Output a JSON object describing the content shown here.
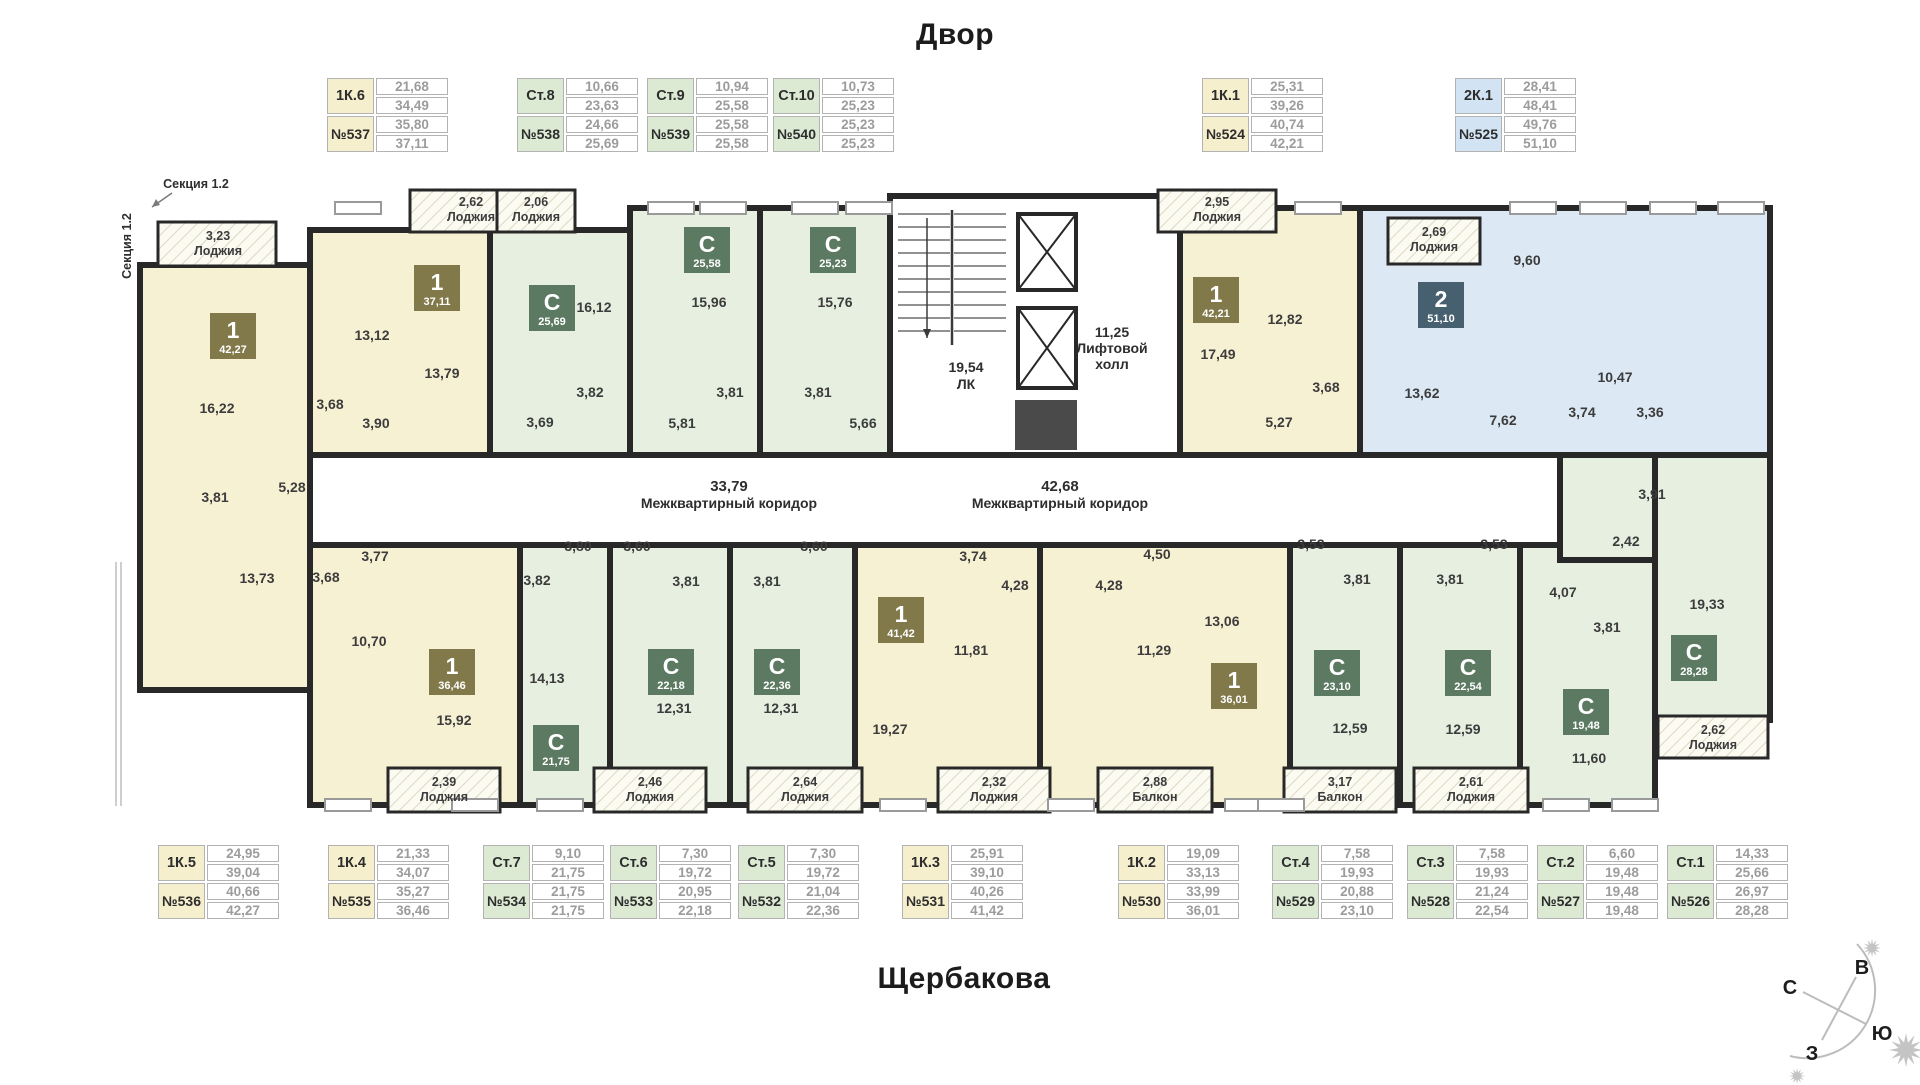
{
  "page": {
    "top_title": "Двор",
    "bottom_title": "Щербакова",
    "section_callout": "Секция 1.2",
    "section_side": "Секция 1.2"
  },
  "compass": {
    "north": "С",
    "east": "В",
    "south": "Ю",
    "west": "З"
  },
  "colors": {
    "wall": "#282828",
    "unit_yellow": "#f7f1d4",
    "unit_green": "#e6efe0",
    "unit_blue": "#dce9f4",
    "badge_olive": "#81794a",
    "badge_sage": "#5c7a62",
    "badge_slate": "#47606f",
    "card_yellow": "#f6efcd",
    "card_green": "#dcead4",
    "card_blue": "#d2e4f3"
  },
  "cards_top": [
    {
      "type": "1К.6",
      "number": "№537",
      "values": [
        "21,68",
        "34,49",
        "35,80",
        "37,11"
      ],
      "color": "yellow"
    },
    {
      "type": "Ст.8",
      "number": "№538",
      "values": [
        "10,66",
        "23,63",
        "24,66",
        "25,69"
      ],
      "color": "green"
    },
    {
      "type": "Ст.9",
      "number": "№539",
      "values": [
        "10,94",
        "25,58",
        "25,58",
        "25,58"
      ],
      "color": "green"
    },
    {
      "type": "Ст.10",
      "number": "№540",
      "values": [
        "10,73",
        "25,23",
        "25,23",
        "25,23"
      ],
      "color": "green"
    },
    {
      "type": "1К.1",
      "number": "№524",
      "values": [
        "25,31",
        "39,26",
        "40,74",
        "42,21"
      ],
      "color": "yellow"
    },
    {
      "type": "2К.1",
      "number": "№525",
      "values": [
        "28,41",
        "48,41",
        "49,76",
        "51,10"
      ],
      "color": "blue"
    }
  ],
  "cards_bottom": [
    {
      "type": "1К.5",
      "number": "№536",
      "values": [
        "24,95",
        "39,04",
        "40,66",
        "42,27"
      ],
      "color": "yellow"
    },
    {
      "type": "1К.4",
      "number": "№535",
      "values": [
        "21,33",
        "34,07",
        "35,27",
        "36,46"
      ],
      "color": "yellow"
    },
    {
      "type": "Ст.7",
      "number": "№534",
      "values": [
        "9,10",
        "21,75",
        "21,75",
        "21,75"
      ],
      "color": "green"
    },
    {
      "type": "Ст.6",
      "number": "№533",
      "values": [
        "7,30",
        "19,72",
        "20,95",
        "22,18"
      ],
      "color": "green"
    },
    {
      "type": "Ст.5",
      "number": "№532",
      "values": [
        "7,30",
        "19,72",
        "21,04",
        "22,36"
      ],
      "color": "green"
    },
    {
      "type": "1К.3",
      "number": "№531",
      "values": [
        "25,91",
        "39,10",
        "40,26",
        "41,42"
      ],
      "color": "yellow"
    },
    {
      "type": "1К.2",
      "number": "№530",
      "values": [
        "19,09",
        "33,13",
        "33,99",
        "36,01"
      ],
      "color": "yellow"
    },
    {
      "type": "Ст.4",
      "number": "№529",
      "values": [
        "7,58",
        "19,93",
        "20,88",
        "23,10"
      ],
      "color": "green"
    },
    {
      "type": "Ст.3",
      "number": "№528",
      "values": [
        "7,58",
        "19,93",
        "21,24",
        "22,54"
      ],
      "color": "green"
    },
    {
      "type": "Ст.2",
      "number": "№527",
      "values": [
        "6,60",
        "19,48",
        "19,48",
        "19,48"
      ],
      "color": "green"
    },
    {
      "type": "Ст.1",
      "number": "№526",
      "values": [
        "14,33",
        "25,66",
        "26,97",
        "28,28"
      ],
      "color": "green"
    }
  ],
  "plan": {
    "corridors": [
      {
        "area": "33,79",
        "name": "Межквартирный коридор",
        "x": 729,
        "y": 487
      },
      {
        "area": "42,68",
        "name": "Межквартирный коридор",
        "x": 1060,
        "y": 487
      }
    ],
    "stairs": {
      "area": "19,54",
      "name": "ЛК",
      "x": 966,
      "y": 368
    },
    "lift": {
      "area": "11,25",
      "lines": [
        "Лифтовой",
        "холл"
      ],
      "x": 1112,
      "y": 333
    },
    "badges": [
      {
        "unit": "№536",
        "t": "1",
        "area": "42,27",
        "x": 233,
        "y": 336,
        "c": "olive"
      },
      {
        "unit": "№537",
        "t": "1",
        "area": "37,11",
        "x": 437,
        "y": 288,
        "c": "olive"
      },
      {
        "unit": "№538",
        "t": "С",
        "area": "25,69",
        "x": 552,
        "y": 308,
        "c": "sage"
      },
      {
        "unit": "№539",
        "t": "С",
        "area": "25,58",
        "x": 707,
        "y": 250,
        "c": "sage"
      },
      {
        "unit": "№540",
        "t": "С",
        "area": "25,23",
        "x": 833,
        "y": 250,
        "c": "sage"
      },
      {
        "unit": "№524",
        "t": "1",
        "area": "42,21",
        "x": 1216,
        "y": 300,
        "c": "olive"
      },
      {
        "unit": "№525",
        "t": "2",
        "area": "51,10",
        "x": 1441,
        "y": 305,
        "c": "slate"
      },
      {
        "unit": "№535",
        "t": "1",
        "area": "36,46",
        "x": 452,
        "y": 672,
        "c": "olive"
      },
      {
        "unit": "№534",
        "t": "С",
        "area": "21,75",
        "x": 556,
        "y": 748,
        "c": "sage"
      },
      {
        "unit": "№533",
        "t": "С",
        "area": "22,18",
        "x": 671,
        "y": 672,
        "c": "sage"
      },
      {
        "unit": "№532",
        "t": "С",
        "area": "22,36",
        "x": 777,
        "y": 672,
        "c": "sage"
      },
      {
        "unit": "№531",
        "t": "1",
        "area": "41,42",
        "x": 901,
        "y": 620,
        "c": "olive"
      },
      {
        "unit": "№530",
        "t": "1",
        "area": "36,01",
        "x": 1234,
        "y": 686,
        "c": "olive"
      },
      {
        "unit": "№529",
        "t": "С",
        "area": "23,10",
        "x": 1337,
        "y": 673,
        "c": "sage"
      },
      {
        "unit": "№528",
        "t": "С",
        "area": "22,54",
        "x": 1468,
        "y": 673,
        "c": "sage"
      },
      {
        "unit": "№527",
        "t": "С",
        "area": "19,48",
        "x": 1586,
        "y": 712,
        "c": "sage"
      },
      {
        "unit": "№526",
        "t": "С",
        "area": "28,28",
        "x": 1694,
        "y": 658,
        "c": "sage"
      }
    ],
    "room_labels": [
      {
        "text": "16,22",
        "x": 217,
        "y": 413
      },
      {
        "text": "3,81",
        "x": 215,
        "y": 502
      },
      {
        "text": "5,28",
        "x": 292,
        "y": 492
      },
      {
        "text": "13,73",
        "x": 257,
        "y": 583
      },
      {
        "text": "13,12",
        "x": 372,
        "y": 340
      },
      {
        "text": "13,79",
        "x": 442,
        "y": 378
      },
      {
        "text": "3,68",
        "x": 330,
        "y": 409
      },
      {
        "text": "3,90",
        "x": 376,
        "y": 428
      },
      {
        "text": "16,12",
        "x": 594,
        "y": 312
      },
      {
        "text": "3,82",
        "x": 590,
        "y": 397
      },
      {
        "text": "3,69",
        "x": 540,
        "y": 427
      },
      {
        "text": "15,96",
        "x": 709,
        "y": 307
      },
      {
        "text": "3,81",
        "x": 730,
        "y": 397
      },
      {
        "text": "5,81",
        "x": 682,
        "y": 428
      },
      {
        "text": "15,76",
        "x": 835,
        "y": 307
      },
      {
        "text": "3,81",
        "x": 818,
        "y": 397
      },
      {
        "text": "5,66",
        "x": 863,
        "y": 428
      },
      {
        "text": "17,49",
        "x": 1218,
        "y": 359
      },
      {
        "text": "12,82",
        "x": 1285,
        "y": 324
      },
      {
        "text": "3,68",
        "x": 1326,
        "y": 392
      },
      {
        "text": "5,27",
        "x": 1279,
        "y": 427
      },
      {
        "text": "13,62",
        "x": 1422,
        "y": 398
      },
      {
        "text": "9,60",
        "x": 1527,
        "y": 265
      },
      {
        "text": "10,47",
        "x": 1615,
        "y": 382
      },
      {
        "text": "7,62",
        "x": 1503,
        "y": 425
      },
      {
        "text": "3,74",
        "x": 1582,
        "y": 417
      },
      {
        "text": "3,36",
        "x": 1650,
        "y": 417
      },
      {
        "text": "10,70",
        "x": 369,
        "y": 646
      },
      {
        "text": "3,68",
        "x": 326,
        "y": 582
      },
      {
        "text": "3,77",
        "x": 375,
        "y": 561
      },
      {
        "text": "15,92",
        "x": 454,
        "y": 725
      },
      {
        "text": "14,13",
        "x": 547,
        "y": 683
      },
      {
        "text": "3,82",
        "x": 537,
        "y": 585
      },
      {
        "text": "3,80",
        "x": 578,
        "y": 551
      },
      {
        "text": "12,31",
        "x": 674,
        "y": 713
      },
      {
        "text": "3,81",
        "x": 686,
        "y": 586
      },
      {
        "text": "3,60",
        "x": 637,
        "y": 551
      },
      {
        "text": "12,31",
        "x": 781,
        "y": 713
      },
      {
        "text": "3,81",
        "x": 767,
        "y": 586
      },
      {
        "text": "3,60",
        "x": 814,
        "y": 551
      },
      {
        "text": "19,27",
        "x": 890,
        "y": 734
      },
      {
        "text": "11,81",
        "x": 971,
        "y": 655
      },
      {
        "text": "4,28",
        "x": 1015,
        "y": 590
      },
      {
        "text": "3,74",
        "x": 973,
        "y": 561
      },
      {
        "text": "13,06",
        "x": 1222,
        "y": 626
      },
      {
        "text": "11,29",
        "x": 1154,
        "y": 655
      },
      {
        "text": "4,28",
        "x": 1109,
        "y": 590
      },
      {
        "text": "4,50",
        "x": 1157,
        "y": 559
      },
      {
        "text": "12,59",
        "x": 1350,
        "y": 733
      },
      {
        "text": "3,81",
        "x": 1357,
        "y": 584
      },
      {
        "text": "3,53",
        "x": 1311,
        "y": 549
      },
      {
        "text": "12,59",
        "x": 1463,
        "y": 734
      },
      {
        "text": "3,81",
        "x": 1450,
        "y": 584
      },
      {
        "text": "3,53",
        "x": 1494,
        "y": 549
      },
      {
        "text": "11,60",
        "x": 1589,
        "y": 763
      },
      {
        "text": "3,81",
        "x": 1607,
        "y": 632
      },
      {
        "text": "4,07",
        "x": 1563,
        "y": 597
      },
      {
        "text": "19,33",
        "x": 1707,
        "y": 609
      },
      {
        "text": "3,91",
        "x": 1652,
        "y": 499
      },
      {
        "text": "2,42",
        "x": 1626,
        "y": 546
      }
    ],
    "loggias": [
      {
        "area": "3,23",
        "name": "Лоджия",
        "rect": [
          158,
          222,
          118,
          44
        ],
        "lx": 218,
        "ly": 240
      },
      {
        "area": "2,62",
        "name": "Лоджия",
        "rect": [
          410,
          190,
          122,
          42
        ],
        "lx": 471,
        "ly": 206
      },
      {
        "area": "2,06",
        "name": "Лоджия",
        "rect": [
          497,
          190,
          78,
          42
        ],
        "lx": 536,
        "ly": 206
      },
      {
        "area": "2,95",
        "name": "Лоджия",
        "rect": [
          1158,
          190,
          118,
          42
        ],
        "lx": 1217,
        "ly": 206
      },
      {
        "area": "2,69",
        "name": "Лоджия",
        "rect": [
          1388,
          218,
          92,
          46
        ],
        "lx": 1434,
        "ly": 236
      },
      {
        "area": "2,39",
        "name": "Лоджия",
        "rect": [
          388,
          768,
          112,
          44
        ],
        "lx": 444,
        "ly": 786
      },
      {
        "area": "2,46",
        "name": "Лоджия",
        "rect": [
          594,
          768,
          112,
          44
        ],
        "lx": 650,
        "ly": 786
      },
      {
        "area": "2,64",
        "name": "Лоджия",
        "rect": [
          748,
          768,
          114,
          44
        ],
        "lx": 805,
        "ly": 786
      },
      {
        "area": "2,32",
        "name": "Лоджия",
        "rect": [
          938,
          768,
          112,
          44
        ],
        "lx": 994,
        "ly": 786
      },
      {
        "area": "2,88",
        "name": "Балкон",
        "rect": [
          1098,
          768,
          114,
          44
        ],
        "lx": 1155,
        "ly": 786
      },
      {
        "area": "3,17",
        "name": "Балкон",
        "rect": [
          1284,
          768,
          112,
          44
        ],
        "lx": 1340,
        "ly": 786
      },
      {
        "area": "2,61",
        "name": "Лоджия",
        "rect": [
          1414,
          768,
          114,
          44
        ],
        "lx": 1471,
        "ly": 786
      },
      {
        "area": "2,62",
        "name": "Лоджия",
        "rect": [
          1658,
          716,
          110,
          42
        ],
        "lx": 1713,
        "ly": 734
      }
    ]
  }
}
